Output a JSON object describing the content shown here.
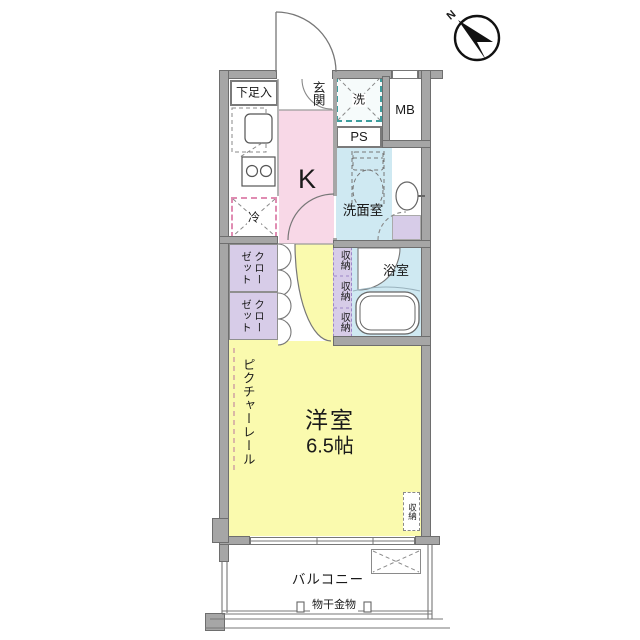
{
  "floorplan": {
    "compass": {
      "north": "N"
    },
    "labels": {
      "shoe_cabinet": "下足入",
      "entrance": "玄関",
      "washer": "洗",
      "meter_box": "MB",
      "pipe_space": "PS",
      "kitchen": "K",
      "fridge": "冷",
      "washroom": "洗面室",
      "closet_upper": "クローゼット",
      "closet_lower": "クローゼット",
      "storage_1": "収納",
      "storage_2": "収納",
      "storage_3": "収納",
      "bathroom": "浴室",
      "picture_rail": "ピクチャーレール",
      "room_name": "洋室",
      "room_size": "6.5帖",
      "room_storage": "収納",
      "balcony": "バルコニー",
      "drying_hardware": "物干金物"
    },
    "colors": {
      "kitchen_fill": "#f8d8e7",
      "room_fill": "#fafaae",
      "wet_area_fill": "#cfe9f2",
      "closet_fill": "#d7cce8",
      "wall": "#a6a6a6",
      "washer_border": "#3d9e9e",
      "fridge_border": "#e08cb2"
    }
  }
}
